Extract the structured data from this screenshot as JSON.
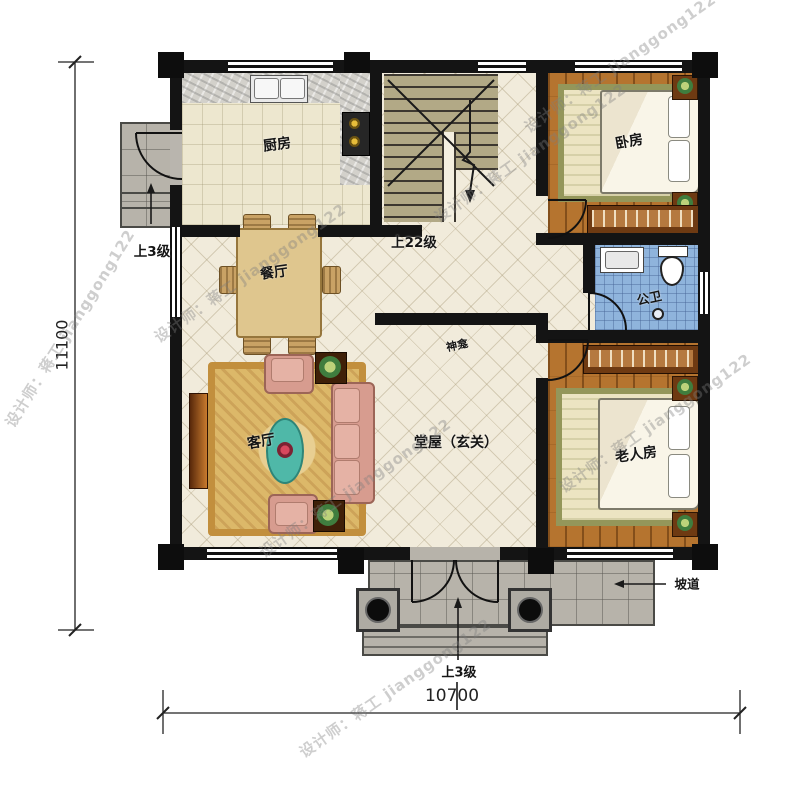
{
  "plan": {
    "rooms": {
      "kitchen": "厨房",
      "dining": "餐厅",
      "living": "客厅",
      "hall": "堂屋（玄关）",
      "shrine": "神龛",
      "bedroom": "卧房",
      "bathroom": "公卫",
      "elder": "老人房"
    },
    "annotations": {
      "stairs": "上22级",
      "side_steps": "上3级",
      "front_steps": "上3级",
      "ramp": "坡道"
    },
    "dimensions": {
      "width": "10700",
      "height": "11100"
    },
    "watermark": {
      "text": "设计师：蒋工 jianggong122"
    },
    "colors": {
      "wall": "#141414",
      "floor_tile": "#f1ebdb",
      "wood": "#b5742f",
      "bath_tile": "#8fb4dc",
      "stair": "#b2a986",
      "porch": "#b7b3aa",
      "rug": "#d9b96a"
    }
  }
}
